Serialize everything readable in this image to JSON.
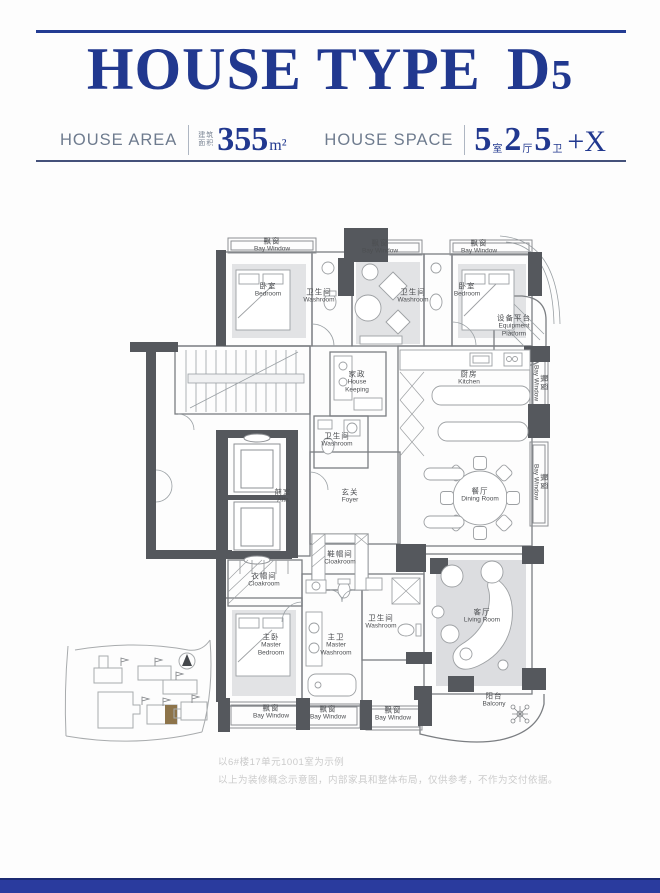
{
  "header": {
    "title": "HOUSE TYPE",
    "title_model": "D",
    "title_model_digit": "5",
    "area": {
      "label": "HOUSE AREA",
      "cn_line1": "建筑",
      "cn_line2": "面积",
      "value": "355",
      "unit": "m²"
    },
    "space": {
      "label": "HOUSE SPACE",
      "groups": [
        {
          "num": "5",
          "unit": "室"
        },
        {
          "num": "2",
          "unit": "厅"
        },
        {
          "num": "5",
          "unit": "卫"
        }
      ],
      "suffix": "+X"
    }
  },
  "plan": {
    "labels": [
      {
        "id": "bay-window-top-1",
        "cn": "飘窗",
        "en": "Bay Window"
      },
      {
        "id": "bay-window-top-2",
        "cn": "飘窗",
        "en": "Bay Window"
      },
      {
        "id": "bay-window-top-3",
        "cn": "飘窗",
        "en": "Bay Window"
      },
      {
        "id": "bedroom-1",
        "cn": "卧室",
        "en": "Bedroom"
      },
      {
        "id": "washroom-1",
        "cn": "卫生间",
        "en": "Washroom"
      },
      {
        "id": "washroom-2",
        "cn": "卫生间",
        "en": "Washroom"
      },
      {
        "id": "bedroom-2",
        "cn": "卧室",
        "en": "Bedroom"
      },
      {
        "id": "equipment-platform",
        "cn": "设备平台",
        "en": "Equipment\nPlatform"
      },
      {
        "id": "house-keeping",
        "cn": "家政",
        "en": "House\nKeeping"
      },
      {
        "id": "kitchen",
        "cn": "厨房",
        "en": "Kitchen"
      },
      {
        "id": "washroom-3",
        "cn": "卫生间",
        "en": "Washroom"
      },
      {
        "id": "anteroom",
        "cn": "前室",
        "en": "Atta"
      },
      {
        "id": "foyer",
        "cn": "玄关",
        "en": "Foyer"
      },
      {
        "id": "dining-room",
        "cn": "餐厅",
        "en": "Dining Room"
      },
      {
        "id": "cloakroom-foyer",
        "cn": "鞋帽间",
        "en": "Cloakroom"
      },
      {
        "id": "cloakroom-master",
        "cn": "衣帽间",
        "en": "Cloakroom"
      },
      {
        "id": "master-bedroom",
        "cn": "主卧",
        "en": "Master\nBedroom"
      },
      {
        "id": "master-washroom",
        "cn": "主卫",
        "en": "Master\nWashroom"
      },
      {
        "id": "washroom-4",
        "cn": "卫生间",
        "en": "Washroom"
      },
      {
        "id": "living-room",
        "cn": "客厅",
        "en": "Living Room"
      },
      {
        "id": "balcony",
        "cn": "阳台",
        "en": "Balcony"
      },
      {
        "id": "bay-window-bottom-1",
        "cn": "飘窗",
        "en": "Bay Window"
      },
      {
        "id": "bay-window-bottom-2",
        "cn": "飘窗",
        "en": "Bay Window"
      },
      {
        "id": "bay-window-bottom-3",
        "cn": "飘窗",
        "en": "Bay Window"
      },
      {
        "id": "bay-window-right-1",
        "cn": "飘窗",
        "en": "Bay Window"
      },
      {
        "id": "bay-window-right-2",
        "cn": "飘窗",
        "en": "Bay Window"
      }
    ]
  },
  "footnotes": {
    "line1": "以6#楼17单元1001室为示例",
    "line2": "以上为装修概念示意图，内部家具和整体布局，仅供参考，不作为交付依据。"
  }
}
